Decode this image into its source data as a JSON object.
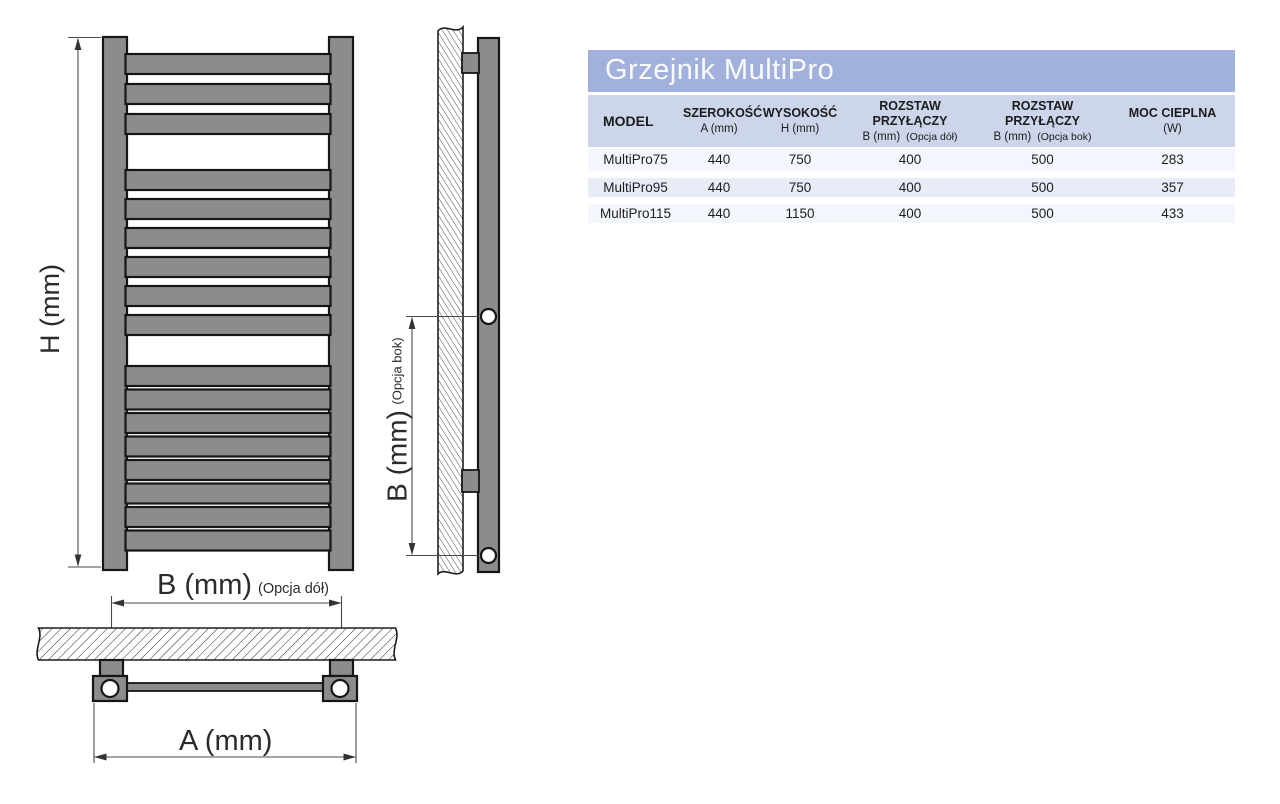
{
  "theme": {
    "title_bg": "#a1b1dc",
    "header_bg": "#cdd5ea",
    "row_light": "#f3f6fc",
    "row_alt": "#e7ecf6",
    "radiator_gray": "#8c8c8c",
    "outline": "#161616",
    "dim_line": "#4a4a4a",
    "label_color": "#2b2b2b",
    "title_text": "#fafafc",
    "header_text": "#1c1c1c",
    "cell_text": "#1e1e1e"
  },
  "diagram": {
    "front_view": {
      "height_label": "H (mm)",
      "bottom_label": "B (mm)",
      "bottom_note": "(Opcja dół)",
      "width_label": "A (mm)"
    },
    "side_view": {
      "side_label": "B (mm)",
      "side_note": "(Opcja bok)"
    }
  },
  "table": {
    "title": "Grzejnik MultiPro",
    "columns": [
      {
        "title": "MODEL",
        "sub": "",
        "note": ""
      },
      {
        "title": "SZEROKOŚĆ",
        "sub": "A (mm)",
        "note": ""
      },
      {
        "title": "WYSOKOŚĆ",
        "sub": "H (mm)",
        "note": ""
      },
      {
        "title": "ROZSTAW PRZYŁĄCZY",
        "sub": "B (mm)",
        "note": "(Opcja dół)"
      },
      {
        "title": "ROZSTAW PRZYŁĄCZY",
        "sub": "B (mm)",
        "note": "(Opcja bok)"
      },
      {
        "title": "MOC CIEPLNA",
        "sub": "(W)",
        "note": ""
      }
    ],
    "rows": [
      {
        "model": "MultiPro75",
        "width_a": "440",
        "height_h": "750",
        "spacing_bottom": "400",
        "spacing_side": "500",
        "power_w": "283"
      },
      {
        "model": "MultiPro95",
        "width_a": "440",
        "height_h": "750",
        "spacing_bottom": "400",
        "spacing_side": "500",
        "power_w": "357"
      },
      {
        "model": "MultiPro115",
        "width_a": "440",
        "height_h": "1150",
        "spacing_bottom": "400",
        "spacing_side": "500",
        "power_w": "433"
      }
    ]
  }
}
